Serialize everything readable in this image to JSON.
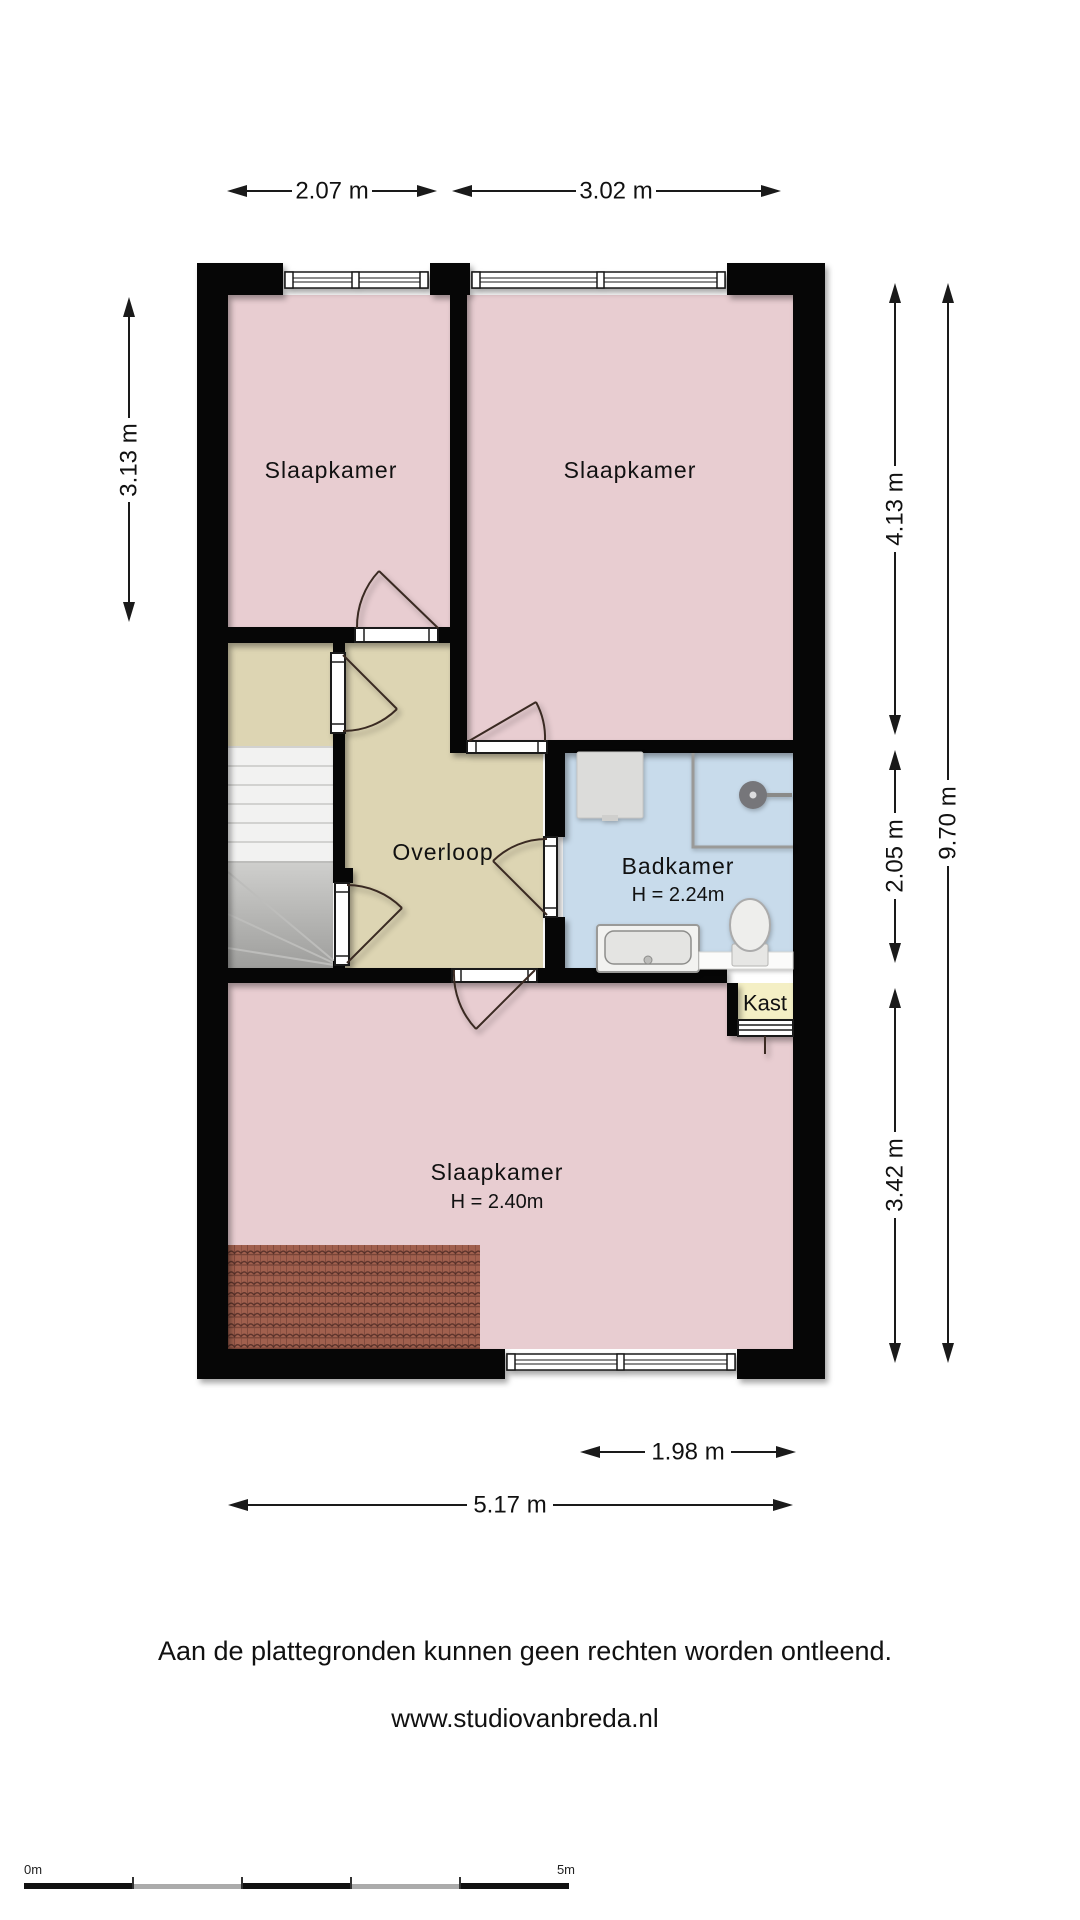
{
  "plan": {
    "type": "floor-plan",
    "floor_rooms": {
      "slaapkamer_left": {
        "label": "Slaapkamer"
      },
      "slaapkamer_right": {
        "label": "Slaapkamer"
      },
      "overloop": {
        "label": "Overloop"
      },
      "badkamer": {
        "label": "Badkamer",
        "ceiling_height": "H = 2.24m"
      },
      "kast": {
        "label": "Kast"
      },
      "slaapkamer_bottom": {
        "label": "Slaapkamer",
        "ceiling_height": "H = 2.40m"
      }
    },
    "dimensions": {
      "top_left": "2.07 m",
      "top_right": "3.02 m",
      "left": "3.13 m",
      "right_top": "4.13 m",
      "right_middle": "2.05 m",
      "right_bottom": "3.42 m",
      "right_total": "9.70 m",
      "bottom_window": "1.98 m",
      "bottom_total": "5.17 m"
    },
    "colors": {
      "bedroom_fill": "#e8cdd1",
      "hallway_fill": "#ddd5b3",
      "bathroom_fill": "#c8dbeb",
      "closet_fill": "#f4efc5",
      "wall": "#060606",
      "stairs_light": "#f2f2f1",
      "stairs_dark": "#a8a8a6",
      "roof_tiles": "#a1604e"
    }
  },
  "footer": {
    "disclaimer": "Aan de plattegronden kunnen geen rechten worden ontleend.",
    "website": "www.studiovanbreda.nl"
  },
  "scale_bar": {
    "start_label": "0m",
    "end_label": "5m",
    "meters": 5
  }
}
